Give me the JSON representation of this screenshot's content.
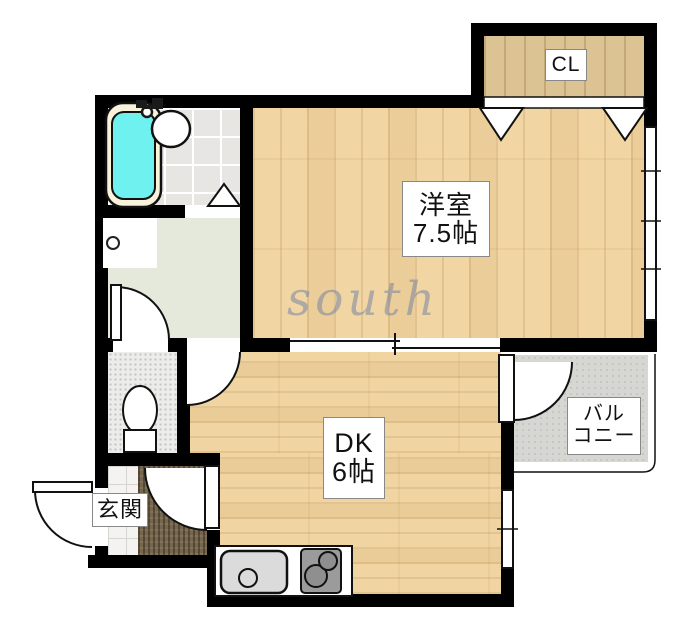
{
  "title": "apartment-floor-plan",
  "watermark": "south",
  "rooms": {
    "closet": {
      "label": "CL"
    },
    "western": {
      "name": "洋室",
      "size": "7.5帖"
    },
    "dining_kitchen": {
      "name": "DK",
      "size": "6帖"
    },
    "balcony": {
      "line1": "バル",
      "line2": "コニー",
      "full_name": "バルコニー"
    },
    "entrance": {
      "name": "玄関"
    }
  },
  "fixtures": [
    "bathtub",
    "washbasin",
    "faucet",
    "washing-machine-pan",
    "toilet",
    "kitchen-sink",
    "stove-two-burner",
    "closet-folding-doors",
    "bath-folding-door",
    "sliding-partition",
    "hinged-doors",
    "windows",
    "balcony-rail"
  ],
  "colors": {
    "wall": "#000000",
    "wood_floor": "#f1d6a4",
    "closet_wood": "#dcc393",
    "bath_tile": "#e8e6e2",
    "hall_floor": "#e5e9dc",
    "toilet_floor": "#ececea",
    "balcony_floor": "#d6d6d2",
    "entrance_tile": "#f4f3f1",
    "entrance_mat": "#75664d",
    "bathtub_water": "#6ff1ef",
    "tub_rim": "#f8f3da",
    "stove": "#9b9b9b",
    "sink": "#dbdbdb",
    "watermark_color": "#7e88a2"
  }
}
